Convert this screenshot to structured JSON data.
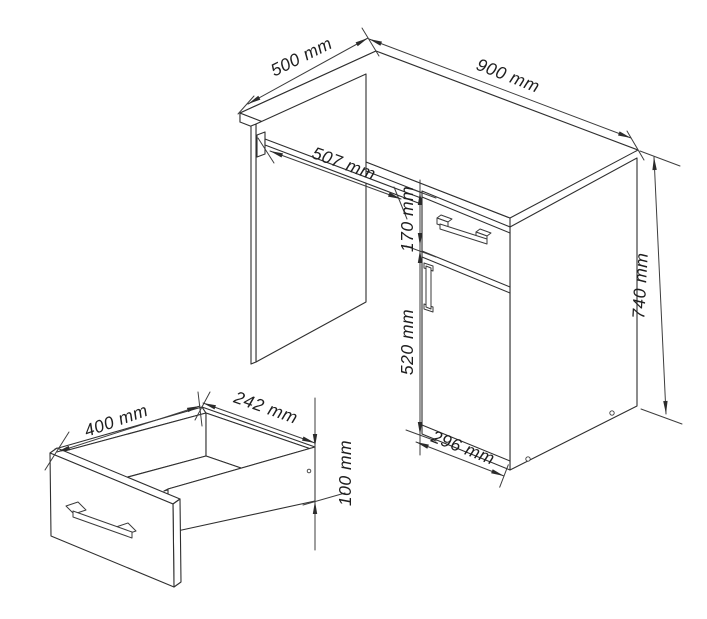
{
  "title": "Desk technical dimension drawing",
  "colors": {
    "line": "#2f2f2f",
    "dimension_line": "#3d3d3d",
    "text": "#1e1e1e",
    "background": "#ffffff"
  },
  "desk": {
    "depth_label": "500 mm",
    "width_label": "900 mm",
    "keyboard_tray_label": "507 mm",
    "drawer_front_height_label": "170 mm",
    "door_height_label": "520 mm",
    "overall_height_label": "740 mm",
    "pedestal_width_label": "296 mm"
  },
  "drawer_detail": {
    "depth_label": "400 mm",
    "inner_width_label": "242 mm",
    "side_height_label": "100 mm"
  }
}
